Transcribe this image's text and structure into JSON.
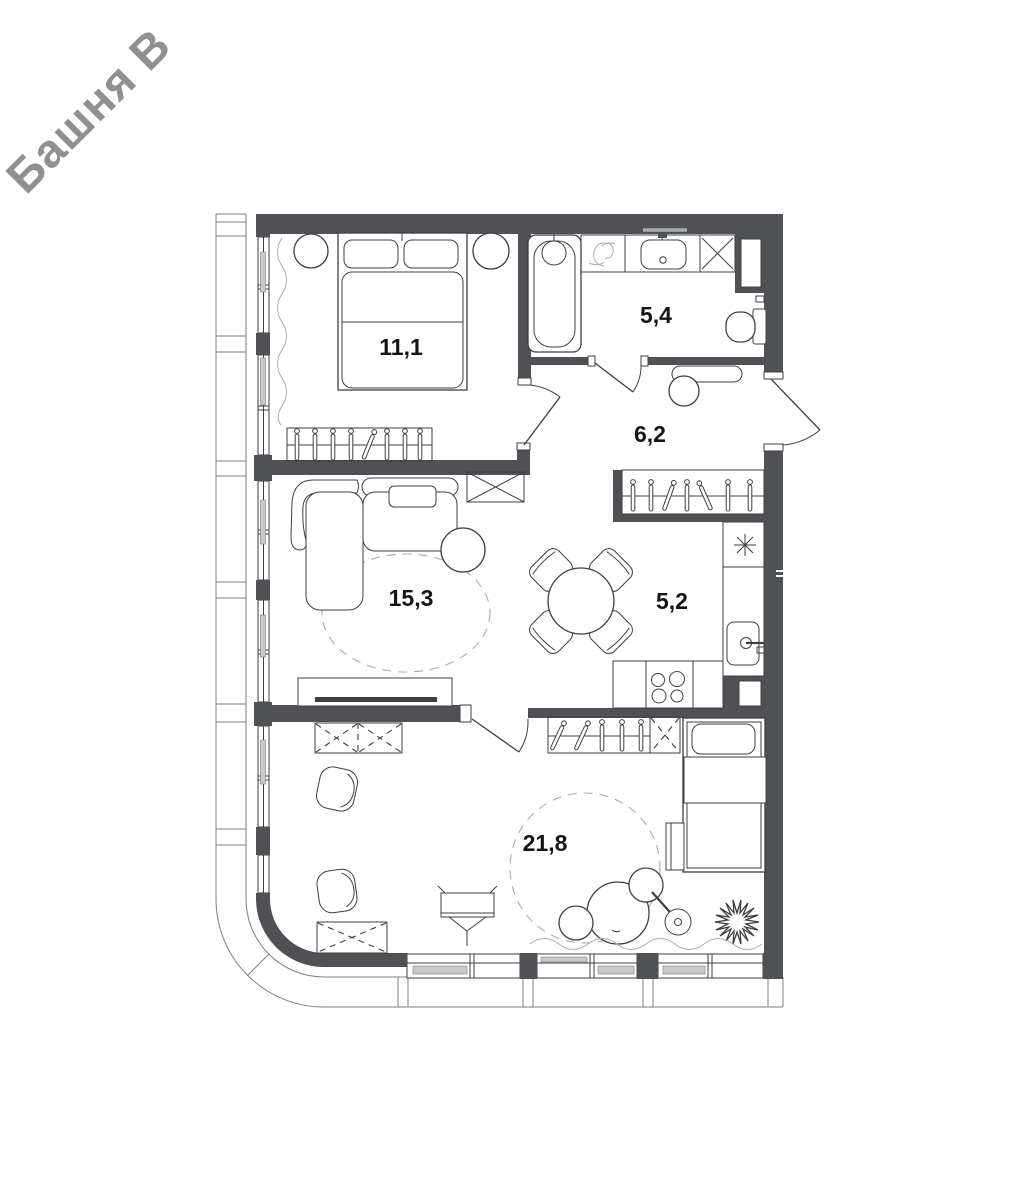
{
  "watermark": "Башня В",
  "rooms": [
    {
      "name": "bedroom",
      "area": "11,1"
    },
    {
      "name": "bathroom",
      "area": "5,4"
    },
    {
      "name": "hallway",
      "area": "6,2"
    },
    {
      "name": "living-room",
      "area": "15,3"
    },
    {
      "name": "kitchen",
      "area": "5,2"
    },
    {
      "name": "bedroom-2",
      "area": "21,8"
    }
  ],
  "colors": {
    "wall": "#4f5154",
    "line": "#3f3f41",
    "light": "#a8adb0",
    "facade": "#7d7f81",
    "sash": "#c9c9c9",
    "label": "#151515",
    "watermark": "#8f9092",
    "background": "#ffffff"
  }
}
